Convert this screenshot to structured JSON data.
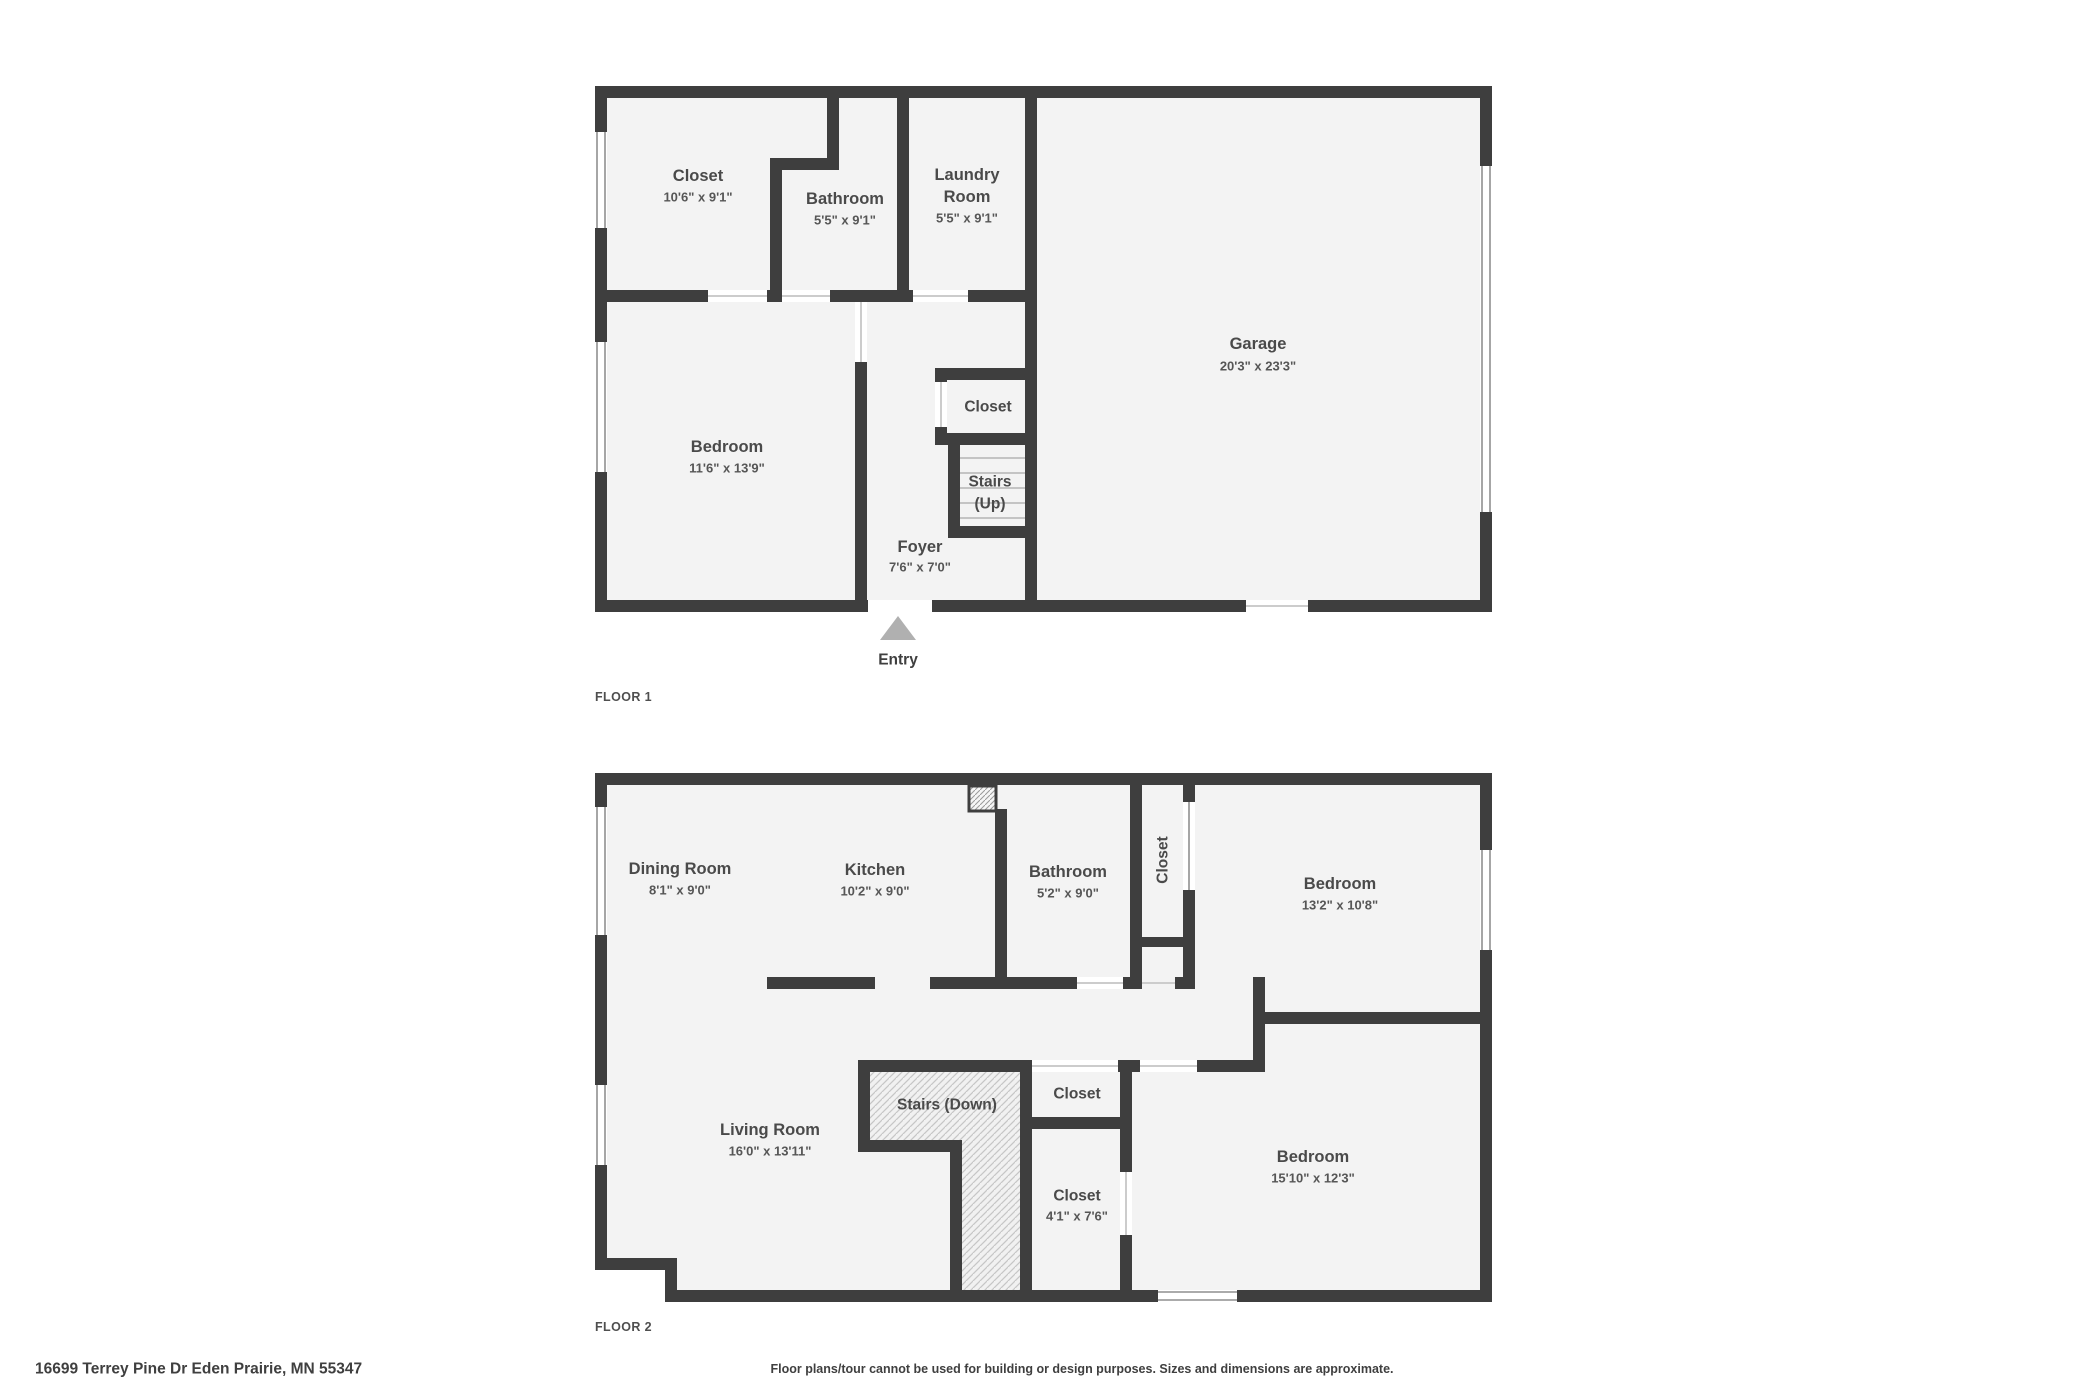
{
  "floor1": {
    "label": "FLOOR 1",
    "entry_label": "Entry",
    "rooms": {
      "closet": {
        "name": "Closet",
        "dims": "10'6\" x 9'1\""
      },
      "bathroom": {
        "name": "Bathroom",
        "dims": "5'5\" x 9'1\""
      },
      "laundry": {
        "name_line1": "Laundry",
        "name_line2": "Room",
        "dims": "5'5\" x 9'1\""
      },
      "garage": {
        "name": "Garage",
        "dims": "20'3\" x 23'3\""
      },
      "bedroom": {
        "name": "Bedroom",
        "dims": "11'6\" x 13'9\""
      },
      "closet_middle": {
        "name": "Closet"
      },
      "stairs": {
        "name_line1": "Stairs",
        "name_line2": "(Up)"
      },
      "foyer": {
        "name": "Foyer",
        "dims": "7'6\" x 7'0\""
      }
    }
  },
  "floor2": {
    "label": "FLOOR 2",
    "rooms": {
      "dining": {
        "name": "Dining Room",
        "dims": "8'1\" x 9'0\""
      },
      "kitchen": {
        "name": "Kitchen",
        "dims": "10'2\" x 9'0\""
      },
      "bathroom": {
        "name": "Bathroom",
        "dims": "5'2\" x 9'0\""
      },
      "closet_column": {
        "name": "Closet"
      },
      "bedroom_top": {
        "name": "Bedroom",
        "dims": "13'2\" x 10'8\""
      },
      "living": {
        "name": "Living Room",
        "dims": "16'0\" x 13'11\""
      },
      "stairs": {
        "name": "Stairs (Down)"
      },
      "closet_small": {
        "name": "Closet"
      },
      "closet_lower": {
        "name": "Closet",
        "dims": "4'1\" x 7'6\""
      },
      "bedroom_bottom": {
        "name": "Bedroom",
        "dims": "15'10\" x 12'3\""
      }
    }
  },
  "footer": {
    "address": "16699 Terrey Pine Dr Eden Prairie, MN 55347",
    "disclaimer": "Floor plans/tour cannot be used for building or design purposes. Sizes and dimensions are approximate."
  },
  "colors": {
    "wall": "#3e3e3e",
    "room_fill": "#f3f3f3",
    "entry_arrow": "#b0b0b0",
    "label_text": "#4a4a4a"
  }
}
